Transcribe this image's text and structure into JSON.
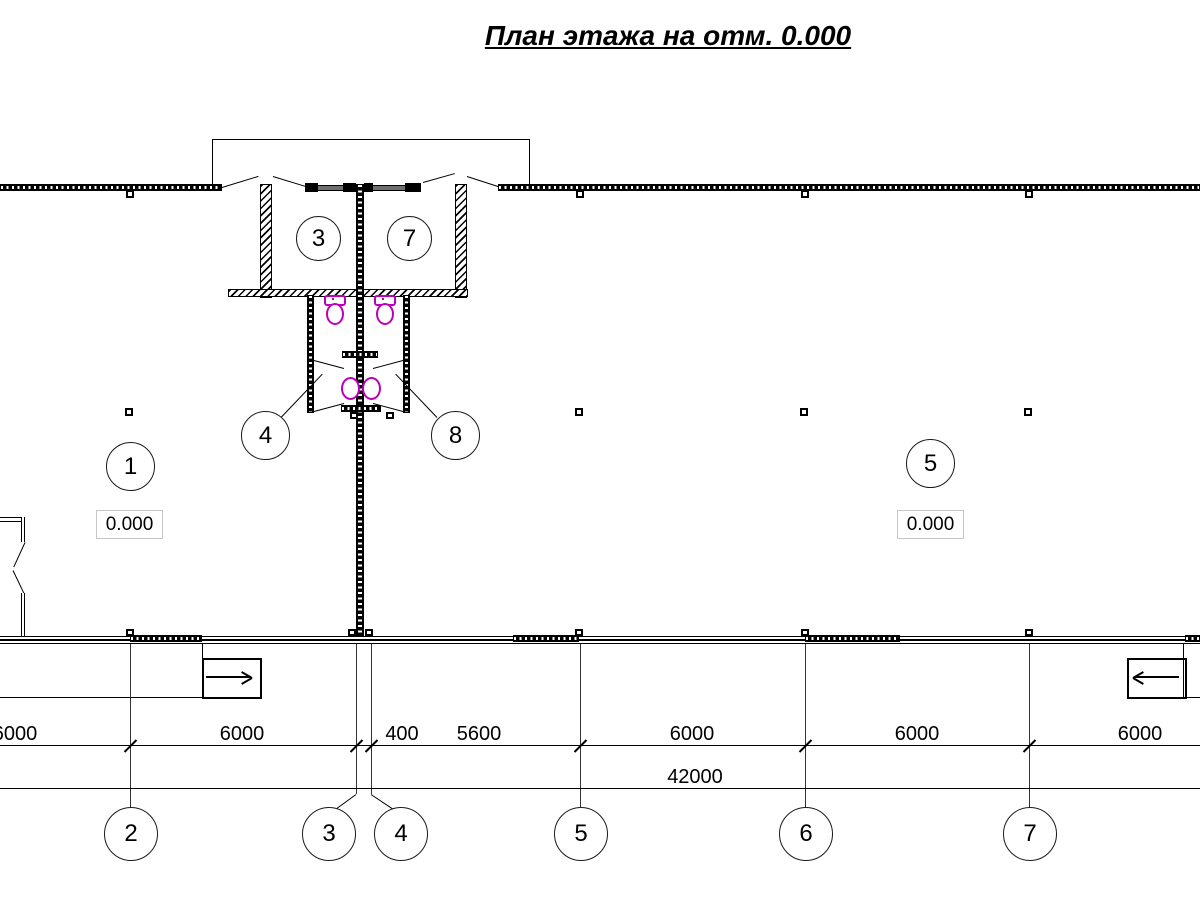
{
  "title": "План этажа на отм. 0.000",
  "room_labels": {
    "r1": "1",
    "r3": "3",
    "r4": "4",
    "r5": "5",
    "r7": "7",
    "r8": "8"
  },
  "elevation_left": "0.000",
  "elevation_right": "0.000",
  "grid_axes": [
    "2",
    "3",
    "4",
    "5",
    "6",
    "7"
  ],
  "dims_row1": [
    "6000",
    "6000",
    "400",
    "5600",
    "6000",
    "6000",
    "6000"
  ],
  "dim_total": "42000",
  "colors": {
    "line": "#000000",
    "fixture_magenta": "#bb00bb",
    "window_gray": "#6f6f6f"
  }
}
